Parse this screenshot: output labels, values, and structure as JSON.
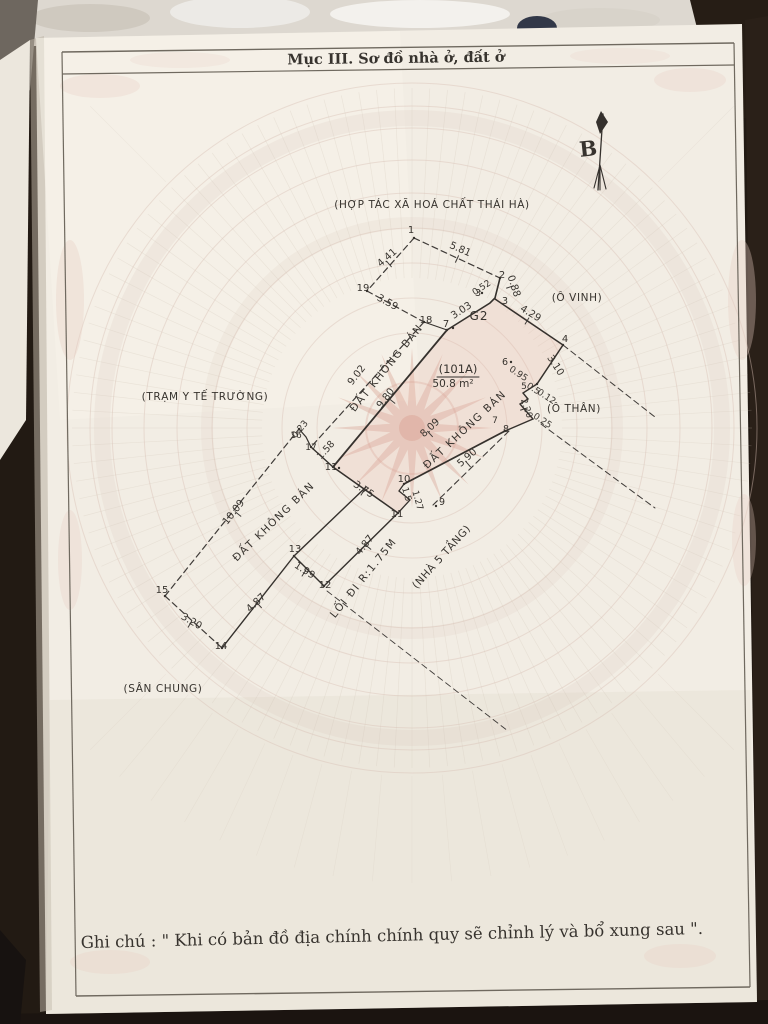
{
  "header": {
    "title": "Mục III. Sơ đồ nhà ở, đất ở"
  },
  "footer": {
    "note": "Ghi chú : \" Khi có bản đồ địa chính chính quy sẽ chỉnh lý và bổ xung sau \"."
  },
  "compass": {
    "label": "B"
  },
  "parcel_info": {
    "id": "(101A)",
    "area": "50.8 m²",
    "block": "G2"
  },
  "colors": {
    "paper": "#f2ede4",
    "ink": "#37332e",
    "line": "#3f3b38",
    "watermark": "#d9c2b6",
    "rays": "#cfc3b5",
    "star": "#d8a294",
    "frame": "#6f695f",
    "background": "#221a13"
  },
  "diagram": {
    "labels": {
      "regions": [
        {
          "t": "(HỢP TÁC XÃ HOÁ CHẤT THÁI HÀ)",
          "x": 432,
          "y": 208,
          "r": 0
        },
        {
          "t": "(Ô VINH)",
          "x": 577,
          "y": 301,
          "r": 0
        },
        {
          "t": "(Ô THÂN)",
          "x": 574,
          "y": 412,
          "r": 0
        },
        {
          "t": "(TRẠM Y TẾ TRƯỜNG)",
          "x": 205,
          "y": 400,
          "r": 0
        },
        {
          "t": "(SÂN CHUNG)",
          "x": 163,
          "y": 692,
          "r": 0
        },
        {
          "t": "(NHÀ 5 TẦNG)",
          "x": 444,
          "y": 559,
          "r": -48
        }
      ],
      "strips": [
        {
          "t": "ĐẤT KHÔNG BÁN",
          "x": 389,
          "y": 370,
          "r": -51
        },
        {
          "t": "ĐẤT KHÔNG BÁN",
          "x": 467,
          "y": 432,
          "r": -43
        },
        {
          "t": "ĐẤT KHÔNG BÁN",
          "x": 276,
          "y": 524,
          "r": -44
        },
        {
          "t": "LỐI ĐI R:1.75M",
          "x": 366,
          "y": 580,
          "r": -51
        }
      ],
      "dims": [
        {
          "t": "4.41",
          "x": 389,
          "y": 260,
          "r": -41
        },
        {
          "t": "5.81",
          "x": 459,
          "y": 252,
          "r": 24
        },
        {
          "t": "3.59",
          "x": 386,
          "y": 305,
          "r": 29
        },
        {
          "t": "0.88",
          "x": 511,
          "y": 287,
          "r": 72
        },
        {
          "t": "0.52",
          "x": 483,
          "y": 290,
          "r": -33,
          "s": 9
        },
        {
          "t": "3.03",
          "x": 463,
          "y": 313,
          "r": -33
        },
        {
          "t": "4.29",
          "x": 529,
          "y": 316,
          "r": 31
        },
        {
          "t": "3.10",
          "x": 553,
          "y": 367,
          "r": 57
        },
        {
          "t": "0.95",
          "x": 517,
          "y": 376,
          "r": 33,
          "s": 9
        },
        {
          "t": "0.5",
          "x": 532,
          "y": 391,
          "r": 33,
          "s": 9
        },
        {
          "t": "0.12",
          "x": 545,
          "y": 399,
          "r": 33,
          "s": 9
        },
        {
          "t": "2.20",
          "x": 524,
          "y": 409,
          "r": 72,
          "s": 9
        },
        {
          "t": "0.25",
          "x": 541,
          "y": 423,
          "r": 33,
          "s": 9
        },
        {
          "t": "8.09",
          "x": 432,
          "y": 430,
          "r": -43
        },
        {
          "t": "5.90",
          "x": 469,
          "y": 460,
          "r": -41
        },
        {
          "t": "9.02",
          "x": 359,
          "y": 377,
          "r": -52
        },
        {
          "t": "9.80",
          "x": 388,
          "y": 400,
          "r": -52
        },
        {
          "t": "0.23",
          "x": 302,
          "y": 431,
          "r": -50,
          "s": 9
        },
        {
          "t": "1.58",
          "x": 328,
          "y": 452,
          "r": -48,
          "s": 9.5
        },
        {
          "t": "3.75",
          "x": 362,
          "y": 492,
          "r": 33
        },
        {
          "t": "1.5",
          "x": 404,
          "y": 495,
          "r": 74,
          "s": 9
        },
        {
          "t": "1.27",
          "x": 415,
          "y": 501,
          "r": 74,
          "s": 9
        },
        {
          "t": "10.09",
          "x": 236,
          "y": 514,
          "r": -52
        },
        {
          "t": "4.87",
          "x": 367,
          "y": 547,
          "r": -51
        },
        {
          "t": "1.99",
          "x": 303,
          "y": 573,
          "r": 33
        },
        {
          "t": "4.87",
          "x": 258,
          "y": 605,
          "r": -43
        },
        {
          "t": "3.20",
          "x": 190,
          "y": 624,
          "r": 30
        }
      ],
      "points": [
        {
          "t": "1",
          "x": 411,
          "y": 233
        },
        {
          "t": "2",
          "x": 502,
          "y": 278
        },
        {
          "t": "3",
          "x": 478,
          "y": 296,
          "s": 9.5
        },
        {
          "t": "3",
          "x": 505,
          "y": 304,
          "s": 9.5
        },
        {
          "t": "4",
          "x": 565,
          "y": 342
        },
        {
          "t": "5",
          "x": 524,
          "y": 389,
          "s": 9
        },
        {
          "t": "6",
          "x": 505,
          "y": 365,
          "s": 9.5
        },
        {
          "t": "7",
          "x": 446,
          "y": 327
        },
        {
          "t": "7",
          "x": 495,
          "y": 423,
          "s": 9
        },
        {
          "t": "8",
          "x": 506,
          "y": 432,
          "s": 9.5
        },
        {
          "t": "9",
          "x": 442,
          "y": 505,
          "s": 9.5
        },
        {
          "t": "10",
          "x": 404,
          "y": 482
        },
        {
          "t": "11",
          "x": 331,
          "y": 470
        },
        {
          "t": "11",
          "x": 397,
          "y": 517
        },
        {
          "t": "12",
          "x": 325,
          "y": 588
        },
        {
          "t": "13",
          "x": 295,
          "y": 552
        },
        {
          "t": "14",
          "x": 221,
          "y": 649
        },
        {
          "t": "15",
          "x": 162,
          "y": 593
        },
        {
          "t": "16",
          "x": 296,
          "y": 438,
          "s": 9
        },
        {
          "t": "17",
          "x": 311,
          "y": 450,
          "s": 9
        },
        {
          "t": "18",
          "x": 426,
          "y": 323
        },
        {
          "t": "19",
          "x": 363,
          "y": 291
        }
      ],
      "parcel": [
        {
          "t": "(101A)",
          "x": 458,
          "y": 373,
          "s": 11.5
        },
        {
          "t": "50.8 m²",
          "x": 453,
          "y": 387,
          "s": 10.5
        },
        {
          "t": "G2",
          "x": 479,
          "y": 320,
          "s": 12,
          "ls": 1
        }
      ]
    }
  }
}
